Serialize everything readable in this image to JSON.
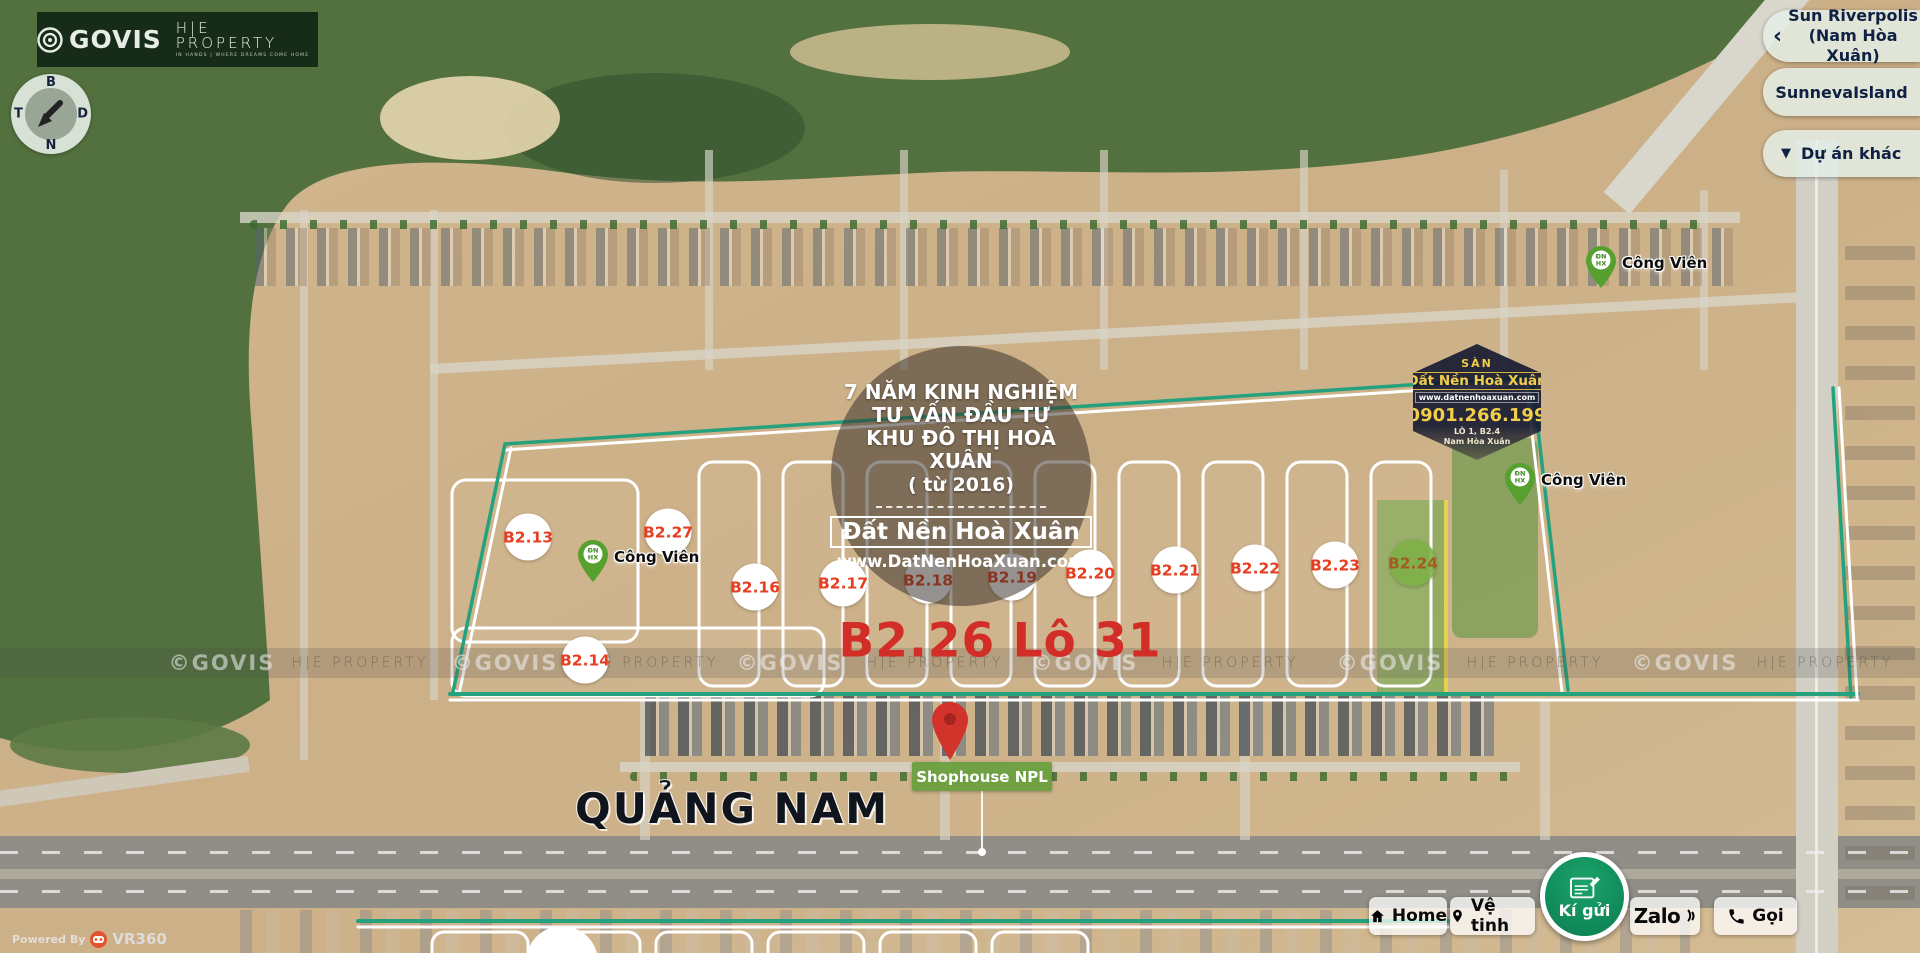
{
  "brand": {
    "govis": "GOVIS",
    "heproperty": "H|E PROPERTY",
    "tagline": "IN HANDS | WHERE DREAMS COME HOME"
  },
  "compass": {
    "north": "B",
    "east": "D",
    "south": "N",
    "west": "T"
  },
  "panel": {
    "project1_line1": "Sun Riverpolis",
    "project1_line2": "(Nam Hòa Xuân)",
    "project1_chevron": "‹",
    "project2": "SunnevaIsland",
    "project3": "Dự án khác",
    "project3_triangle": "▼"
  },
  "info_circle": {
    "lines": [
      "7 NĂM KINH NGHIỆM",
      "TƯ VẤN ĐẦU TƯ",
      "KHU ĐÔ THỊ HOÀ XUÂN",
      "( từ 2016)"
    ],
    "brand": "Đất Nền Hoà Xuân",
    "website": "www.DatNenHoaXuan.com"
  },
  "hexagon_badge": {
    "top": "SÀN",
    "brand": "Đất Nền Hoà Xuân",
    "website": "www.datnenhoaxuan.com",
    "phone": "0901.266.199",
    "address_line1": "LÔ 1, B2.4",
    "address_line2": "Nam Hòa Xuân"
  },
  "selected_lot": {
    "label": "B2.26 Lô 31"
  },
  "road_label": "QUẢNG NAM",
  "marker": {
    "label": "Shophouse NPL"
  },
  "parcels": [
    {
      "label": "B2.13",
      "x": 528,
      "y": 537
    },
    {
      "label": "B2.27",
      "x": 668,
      "y": 532
    },
    {
      "label": "B2.14",
      "x": 585,
      "y": 660
    },
    {
      "label": "B2.16",
      "x": 755,
      "y": 587
    },
    {
      "label": "B2.17",
      "x": 843,
      "y": 583
    },
    {
      "label": "B2.18",
      "x": 928,
      "y": 580
    },
    {
      "label": "B2.19",
      "x": 1012,
      "y": 577
    },
    {
      "label": "B2.20",
      "x": 1090,
      "y": 573
    },
    {
      "label": "B2.21",
      "x": 1175,
      "y": 570
    },
    {
      "label": "B2.22",
      "x": 1255,
      "y": 568
    },
    {
      "label": "B2.23",
      "x": 1335,
      "y": 565
    },
    {
      "label": "B2.24",
      "x": 1413,
      "y": 563,
      "variant": "green"
    }
  ],
  "park_pins": [
    {
      "label": "Công Viên",
      "x": 578,
      "y": 540,
      "logo1": "ĐN",
      "logo2": "HX"
    },
    {
      "label": "Công Viên",
      "x": 1586,
      "y": 246,
      "logo1": "ĐN",
      "logo2": "HX"
    },
    {
      "label": "Công Viên",
      "x": 1505,
      "y": 463,
      "logo1": "ĐN",
      "logo2": "HX"
    }
  ],
  "watermarks": [
    {
      "text": "©GOVIS",
      "x": 222,
      "variant": "wm-govis"
    },
    {
      "text": "H|E PROPERTY",
      "x": 360,
      "variant": "wm-he"
    },
    {
      "text": "©GOVIS",
      "x": 505,
      "variant": "wm-govis"
    },
    {
      "text": "H|E PROPERTY",
      "x": 650,
      "variant": "wm-he"
    },
    {
      "text": "©GOVIS",
      "x": 790,
      "variant": "wm-govis"
    },
    {
      "text": "H|E PROPERTY",
      "x": 935,
      "variant": "wm-he"
    },
    {
      "text": "©GOVIS",
      "x": 1085,
      "variant": "wm-govis"
    },
    {
      "text": "H|E PROPERTY",
      "x": 1230,
      "variant": "wm-he"
    },
    {
      "text": "©GOVIS",
      "x": 1390,
      "variant": "wm-govis"
    },
    {
      "text": "H|E PROPERTY",
      "x": 1535,
      "variant": "wm-he"
    },
    {
      "text": "©GOVIS",
      "x": 1685,
      "variant": "wm-govis"
    },
    {
      "text": "H|E PROPERTY",
      "x": 1825,
      "variant": "wm-he"
    }
  ],
  "controls": {
    "home": "Home",
    "satellite": "Vệ tinh",
    "consign": "Kí gửi",
    "zalo": "Zalo",
    "call": "Gọi"
  },
  "powered": {
    "prefix": "Powered By",
    "brand": "VR360"
  },
  "colors": {
    "boundary_teal": "#26a17e",
    "selected_red": "#d22d26",
    "marker_green": "#689e3c",
    "panel_navy": "#0e2142",
    "badge_yellow": "#f2ce4a",
    "consign_green": "#0e8e5c"
  }
}
